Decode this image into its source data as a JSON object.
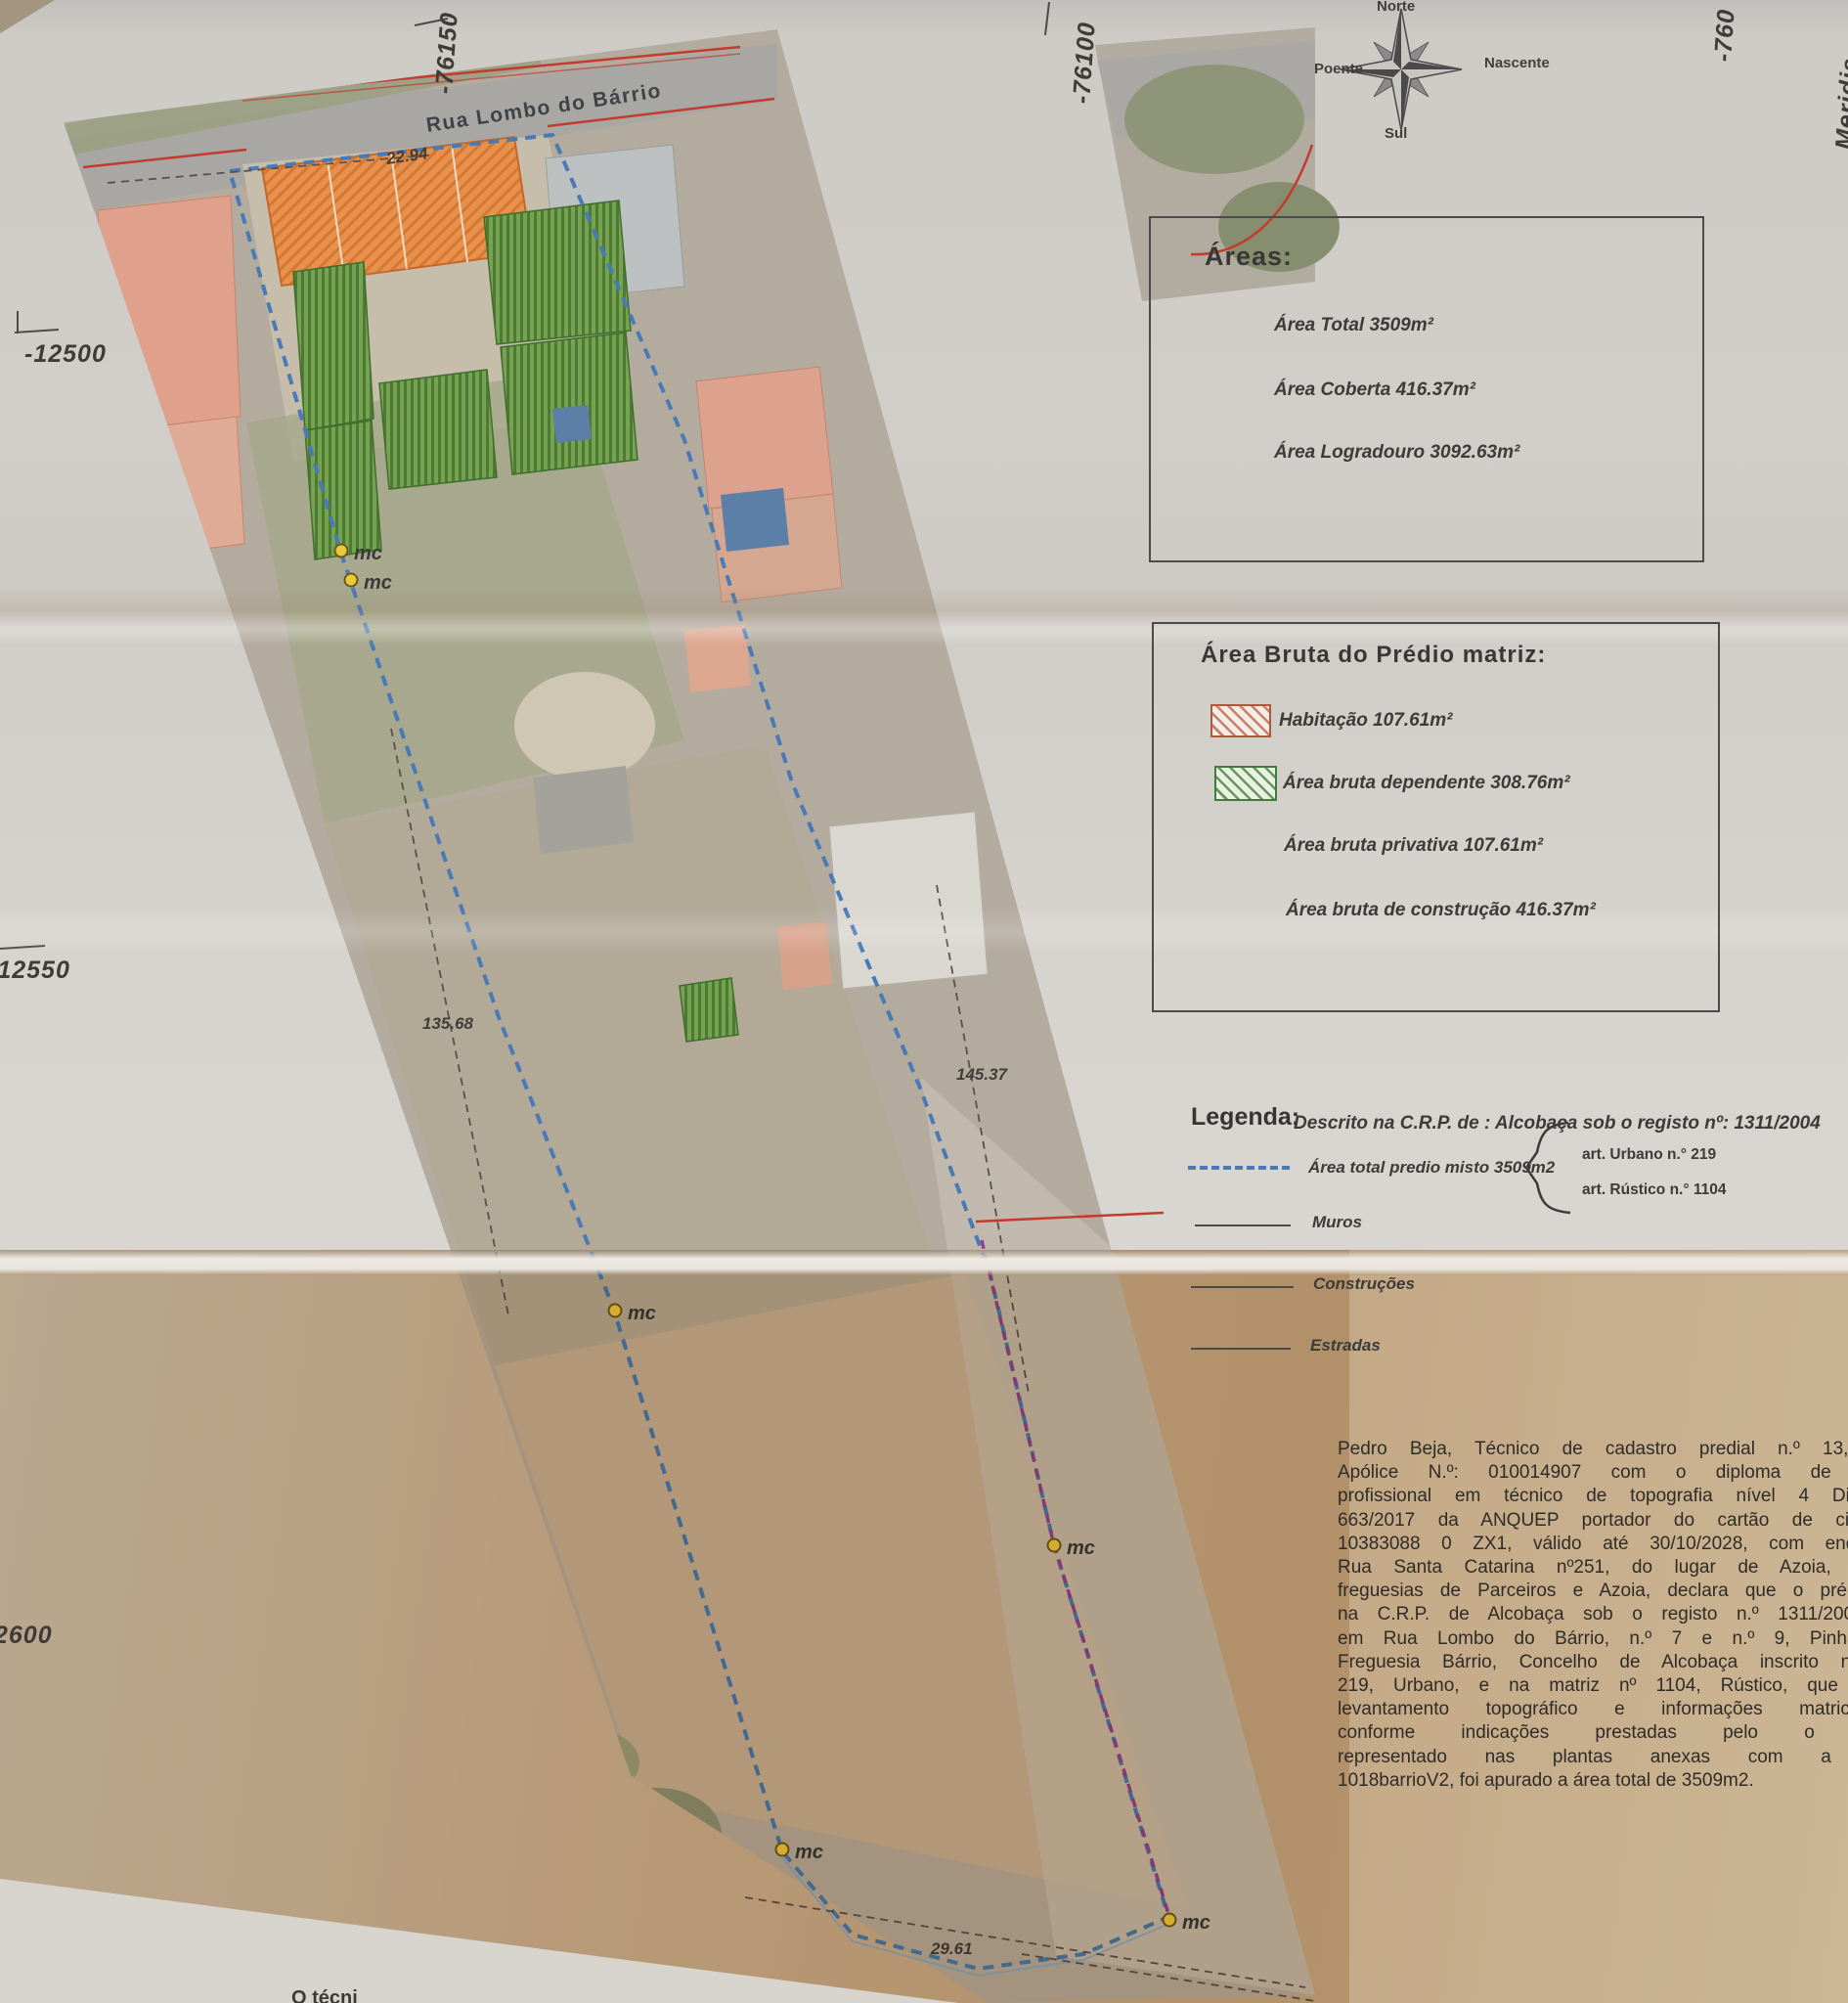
{
  "grid": {
    "top_left": "-76150",
    "top_mid": "-76100",
    "top_right": "-760",
    "right_edge": "Meridia",
    "left_top": "-12500",
    "left_mid": "-12550",
    "left_bottom": "2600",
    "bottom_note": "O técni"
  },
  "compass": {
    "north": "Norte",
    "east": "Nascente",
    "south": "Sul",
    "west": "Poente"
  },
  "areas_box": {
    "title": "Áreas:",
    "total": "Área Total 3509m²",
    "coberta": "Área  Coberta 416.37m²",
    "logradouro": "Área Logradouro 3092.63m²"
  },
  "bruta_box": {
    "title": "Área Bruta do Prédio matriz:",
    "habitacao": "Habitação 107.61m²",
    "dependente": "Área bruta dependente 308.76m²",
    "privativa": "Área bruta privativa 107.61m²",
    "construcao": "Área bruta de construção 416.37m²"
  },
  "legend": {
    "title": "Legenda:",
    "descrito": "Descrito na C.R.P. de : Alcobaça sob o registo nº: 1311/2004",
    "area_total": "Área total predio misto 3509m2",
    "art_urbano": "art.  Urbano n.° 219",
    "art_rustico": "art.  Rústico n.° 1104",
    "muros": "Muros",
    "construcoes": "Construções",
    "estradas": "Estradas"
  },
  "map": {
    "street": "Rua Lombo do Bárrio",
    "marker": "mc",
    "dim_frontage": "22.94",
    "dim_left": "135.68",
    "dim_right": "145.37",
    "dim_bottom": "29.61"
  },
  "declaration": {
    "lines": [
      "Pedro Beja, Técnico de cadastro predial n.º 13, topógra",
      "Apólice N.º: 010014907 com o diploma de certificaç",
      "profissional em técnico de topografia nível 4 Diploma n",
      "663/2017 da ANQUEP portador do cartão de cidadão n",
      "10383088 0 ZX1, válido até 30/10/2028, com endereço n",
      "Rua Santa Catarina nº251, do lugar de Azoia, União d",
      "freguesias de Parceiros e Azoia, declara que o prédio descr",
      "na C.R.P. de Alcobaça sob o registo n.º 1311/20040423 s",
      "em Rua Lombo do Bárrio, n.º 7 e n.º 9, Pinhal Fanhe",
      "Freguesia Bárrio, Concelho de Alcobaça inscrito na matriz",
      "219, Urbano, e na matriz nº 1104, Rústico, que o prese",
      "levantamento topográfico e informações matriciais es",
      "conforme indicações prestadas pelo o proprietá",
      "representado nas plantas anexas com a designa",
      "1018barrioV2, foi apurado a área total de 3509m2."
    ]
  },
  "colors": {
    "boundary_blue": "#4a7ab5",
    "boundary_purple": "#90438e",
    "road_red": "#c23b2e",
    "habitacao_orange": "#e8914e",
    "dependente_green": "#6f9c4e",
    "marker_yellow": "#e9c93b"
  }
}
